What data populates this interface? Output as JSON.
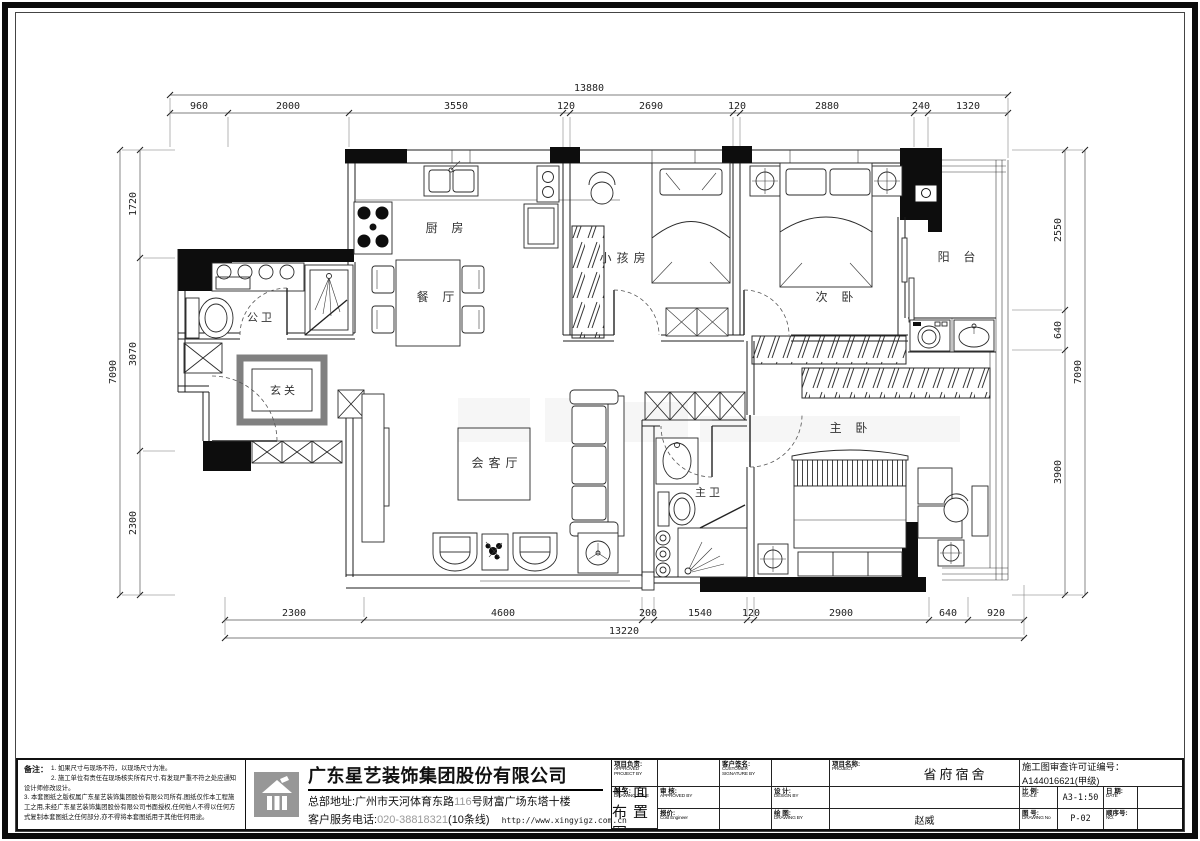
{
  "plan": {
    "rooms": {
      "kitchen": "厨 房",
      "dining": "餐 厅",
      "kids_room": "小孩房",
      "second_bedroom": "次 卧",
      "balcony": "阳 台",
      "public_bathroom": "公卫",
      "entry": "玄关",
      "living_room": "会客厅",
      "master_bathroom": "主卫",
      "master_bedroom": "主 卧"
    },
    "dimensions": {
      "top_total": "13880",
      "top": [
        "960",
        "2000",
        "3550",
        "120",
        "2690",
        "120",
        "2880",
        "240",
        "1320"
      ],
      "bottom": [
        "2300",
        "4600",
        "200",
        "1540",
        "120",
        "2900",
        "640",
        "920"
      ],
      "bottom_total": "13220",
      "left": [
        "1720",
        "3070",
        "2300"
      ],
      "left_total": "7090",
      "right": [
        "2550",
        "640",
        "3900"
      ],
      "right_total": "7090"
    }
  },
  "notes": {
    "title": "备注：",
    "items": [
      "1. 如果尺寸与现场不符，以现场尺寸为准。",
      "2. 施工单位有责任在现场核实所有尺寸,有发现严重不符之处应通知设计师修改设计。",
      "3. 本套图纸之版权属广东星艺装饰集团股份有限公司所有,图纸仅作本工程施工之用,未经广东星艺装饰集团股份有限公司书面授权,任何他人不得以任何方式复制本套图纸之任何部分,亦不得将本套图纸用于其他任何用途。"
    ]
  },
  "company": {
    "name": "广东星艺装饰集团股份有限公司",
    "address_prefix": "总部地址:广州市天河体育东路",
    "address_number": "116",
    "address_suffix": "号财富广场东塔十楼",
    "phone_label": "客户服务电话:",
    "phone_number": "020-38818321",
    "phone_suffix": "(10条线)",
    "website": "http://www.xingyigz.com.cn"
  },
  "titleblock": {
    "project_lead_label": "项目负责:",
    "project_lead_en": "APPROVED PROJECT BY",
    "customer_label": "客户签名:",
    "customer_en": "CUSTOMER SIGNATURE BY",
    "project_label": "项目名称:",
    "project_en": "PROJECT",
    "project_value": "省府宿舍",
    "permit": "施工图审查许可证编号：A144016621(甲级)",
    "approved_label": "审 核:",
    "approved_en": "APPROVED BY",
    "design_label": "设 计:",
    "design_en": "DESIGN BY",
    "drawing_title_label": "图 名:",
    "drawing_title_en": "DRAWING TITLE",
    "drawing_title_value": "平面布置图",
    "scale_label": "比 例:",
    "scale_en": "SCALE",
    "scale_value": "A3-1:50",
    "date_label": "日 期:",
    "date_en": "DATE",
    "quote_label": "报价:",
    "quote_en": "Cost Engineer",
    "drawing_by_label": "绘 图:",
    "drawing_by_en": "DRAWING BY",
    "drawing_by_value": "赵威",
    "drawing_no_label": "图 号:",
    "drawing_no_en": "DRAWING No",
    "drawing_no_value": "P-02",
    "serial_label": "顺序号:",
    "serial_en": "NO."
  }
}
